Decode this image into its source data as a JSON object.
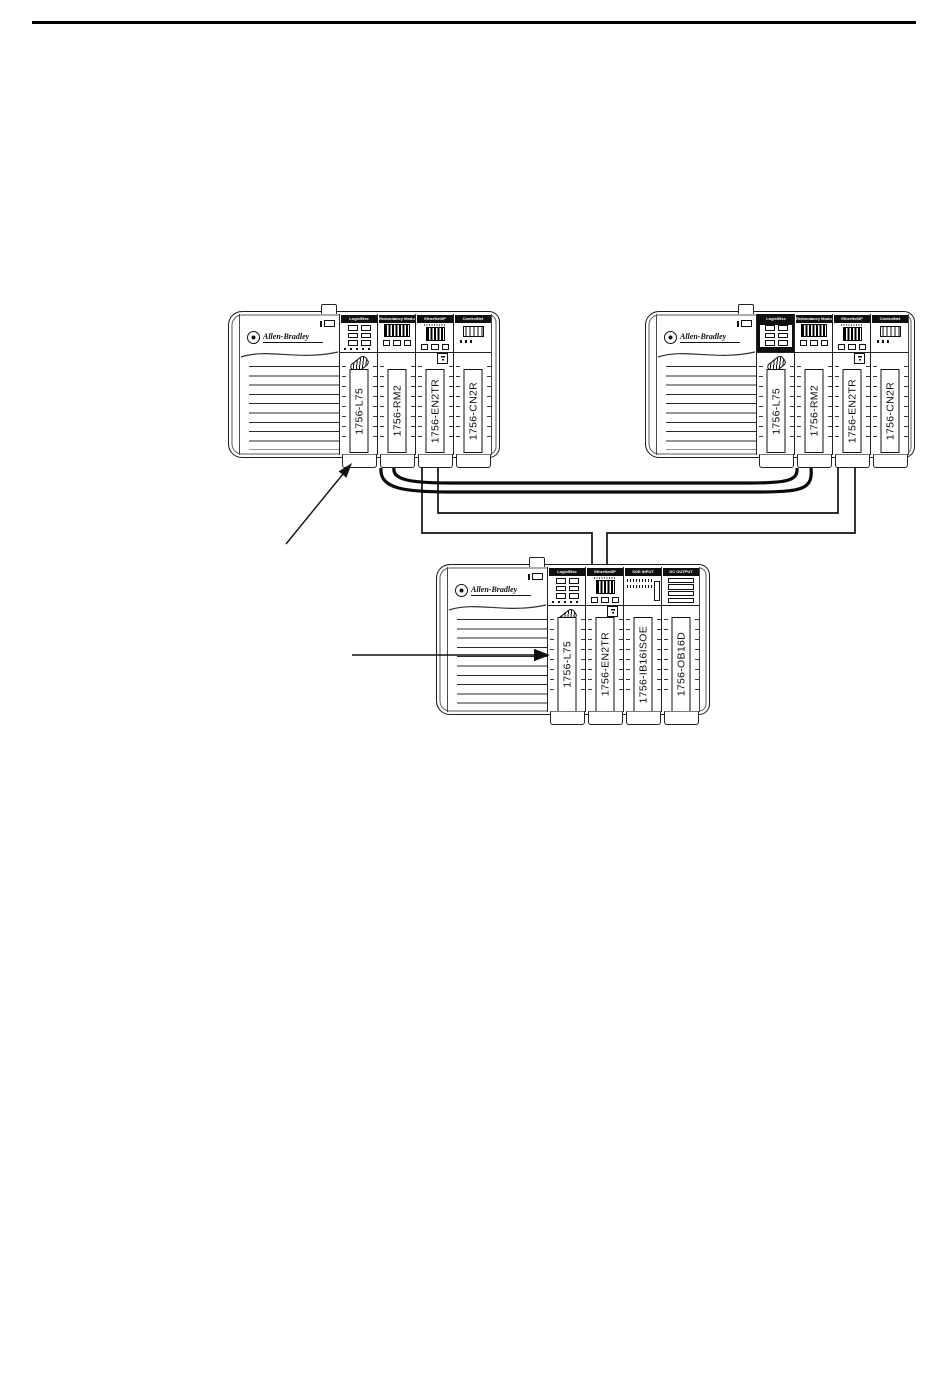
{
  "page": {
    "background": "#ffffff",
    "rule_color": "#000000",
    "line_color": "#000000"
  },
  "diagram": {
    "chassis": [
      {
        "id": "top-left",
        "brand": "Allen-Bradley",
        "modules": [
          {
            "header": "Logix55xx",
            "label": "1756-L75",
            "type": "controller"
          },
          {
            "header": "Redundancy Module",
            "label": "1756-RM2",
            "type": "redundancy"
          },
          {
            "header": "EtherNet/IP",
            "label": "1756-EN2TR",
            "type": "ethernet"
          },
          {
            "header": "ControlNet",
            "label": "1756-CN2R",
            "type": "controlnet"
          }
        ]
      },
      {
        "id": "top-right",
        "brand": "Allen-Bradley",
        "modules": [
          {
            "header": "Logix55xx",
            "label": "1756-L75",
            "type": "controller"
          },
          {
            "header": "Redundancy Module",
            "label": "1756-RM2",
            "type": "redundancy"
          },
          {
            "header": "EtherNet/IP",
            "label": "1756-EN2TR",
            "type": "ethernet"
          },
          {
            "header": "ControlNet",
            "label": "1756-CN2R",
            "type": "controlnet"
          }
        ]
      },
      {
        "id": "bottom",
        "brand": "Allen-Bradley",
        "modules": [
          {
            "header": "Logix55xx",
            "label": "1756-L75",
            "type": "controller"
          },
          {
            "header": "EtherNet/IP",
            "label": "1756-EN2TR",
            "type": "ethernet"
          },
          {
            "header": "SOE INPUT",
            "label": "1756-IB16ISOE",
            "type": "soe-input"
          },
          {
            "header": "DC OUTPUT",
            "label": "1756-OB16D",
            "type": "dc-output"
          }
        ]
      }
    ]
  }
}
